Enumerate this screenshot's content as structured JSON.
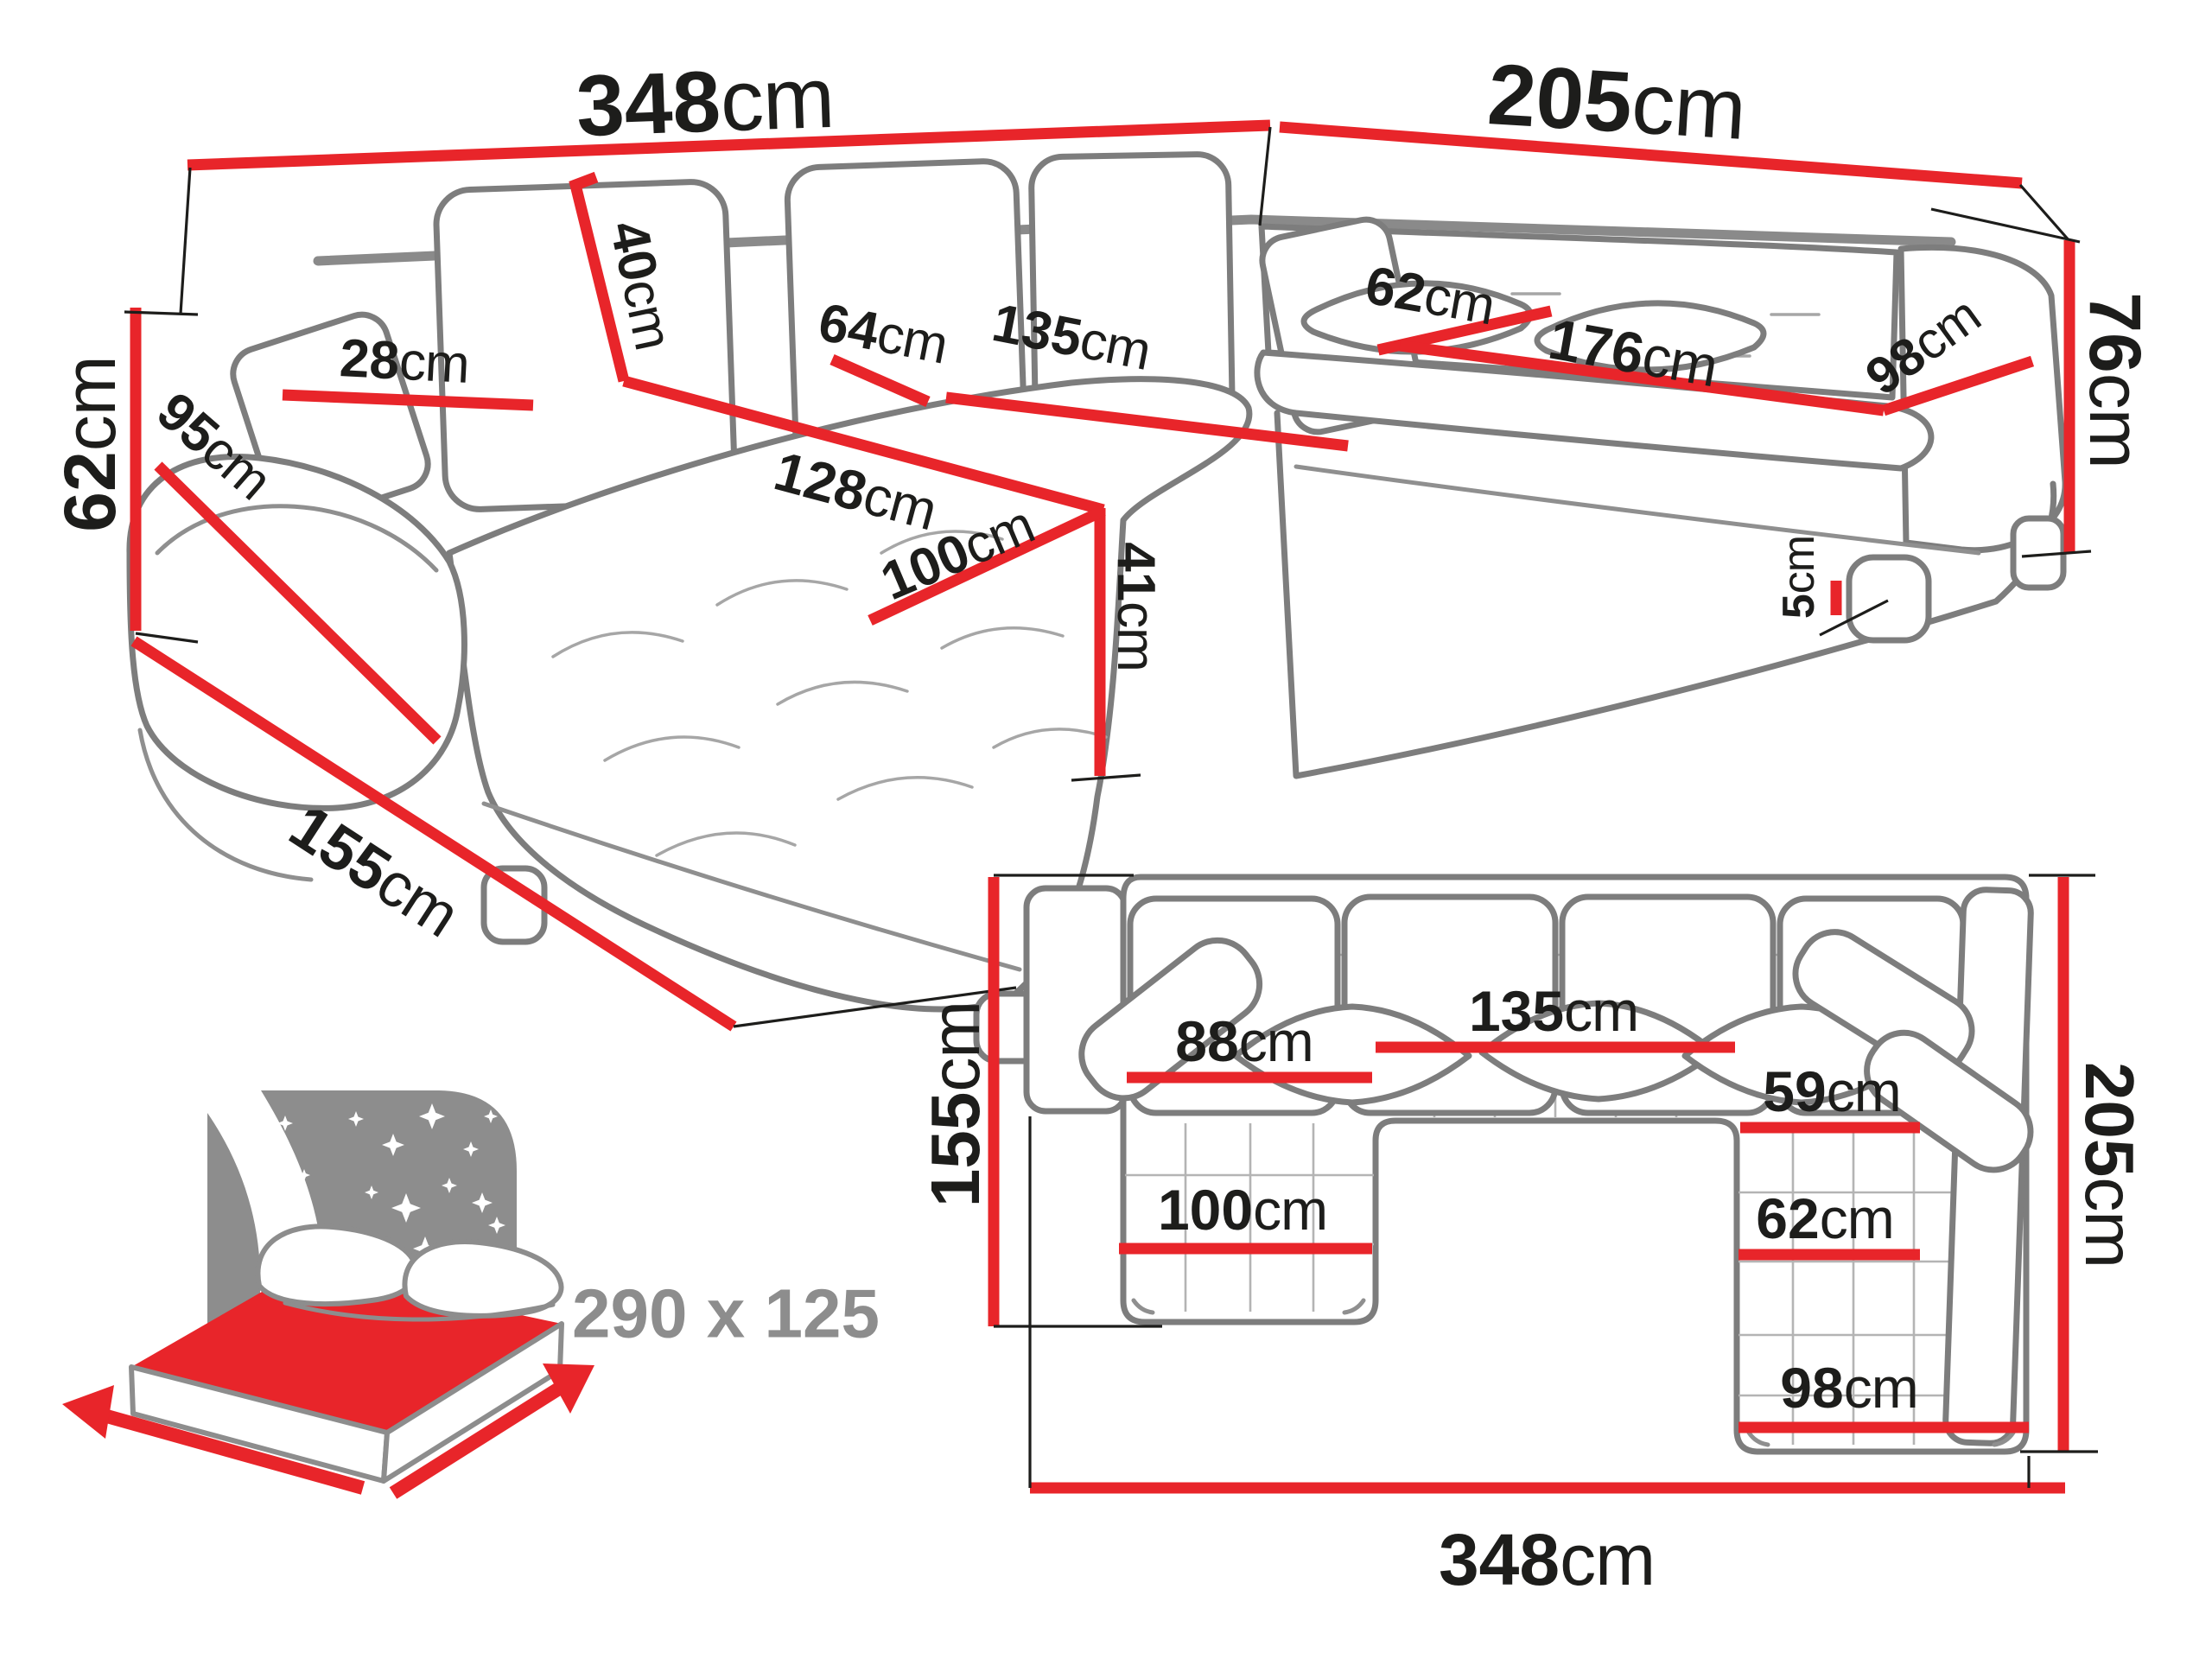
{
  "title": "U-shaped corner sofa dimensions diagram",
  "colors": {
    "dimension_red": "#e8252a",
    "outline_gray": "#7d7d7d",
    "text_black": "#1d1d1b",
    "icon_gray": "#8d8d8d",
    "background": "#ffffff"
  },
  "perspective_view": {
    "dimensions": {
      "back_width_left": {
        "value": "348",
        "unit": "cm"
      },
      "back_width_right": {
        "value": "205",
        "unit": "cm"
      },
      "armrest_height": {
        "value": "62",
        "unit": "cm"
      },
      "side_depth": {
        "value": "155",
        "unit": "cm"
      },
      "armrest_length": {
        "value": "95",
        "unit": "cm"
      },
      "armrest_width": {
        "value": "28",
        "unit": "cm"
      },
      "back_cushion_height": {
        "value": "40",
        "unit": "cm"
      },
      "seat_depth_left": {
        "value": "64",
        "unit": "cm"
      },
      "center_seat_width": {
        "value": "135",
        "unit": "cm"
      },
      "chaise_length": {
        "value": "128",
        "unit": "cm"
      },
      "chaise_width": {
        "value": "100",
        "unit": "cm"
      },
      "seat_height": {
        "value": "41",
        "unit": "cm"
      },
      "seat_depth_right": {
        "value": "62",
        "unit": "cm"
      },
      "right_seat_width": {
        "value": "176",
        "unit": "cm"
      },
      "right_end_width": {
        "value": "98",
        "unit": "cm"
      },
      "backrest_height": {
        "value": "76",
        "unit": "cm"
      },
      "leg_height": {
        "value": "5",
        "unit": "cm"
      }
    }
  },
  "plan_view": {
    "dimensions": {
      "left_depth": {
        "value": "155",
        "unit": "cm"
      },
      "total_depth": {
        "value": "205",
        "unit": "cm"
      },
      "total_width": {
        "value": "348",
        "unit": "cm"
      },
      "center_width": {
        "value": "135",
        "unit": "cm"
      },
      "left_seat_width": {
        "value": "88",
        "unit": "cm"
      },
      "right_seat_width": {
        "value": "59",
        "unit": "cm"
      },
      "left_chaise_width": {
        "value": "100",
        "unit": "cm"
      },
      "right_chaise_width": {
        "value": "62",
        "unit": "cm"
      },
      "right_bottom_width": {
        "value": "98",
        "unit": "cm"
      }
    }
  },
  "sleeping_area": {
    "label": "290 x 125"
  }
}
